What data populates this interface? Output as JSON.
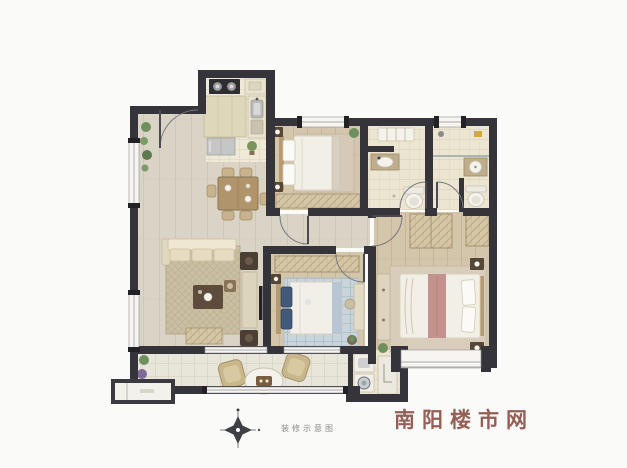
{
  "watermark": {
    "text": "南阳楼市网",
    "color": "#8a4f46"
  },
  "compass": {
    "icon": "compass-rose-icon",
    "caption": "装修示意图",
    "caption_color": "#8a8a8a"
  },
  "colors": {
    "wall": "#34343a",
    "bg": "#fafaf8",
    "floor-main": "#d9d4c5",
    "floor-wood": "#d3c6ab",
    "floor-tile": "#ebe5d2",
    "floor-balcony": "#e8e5da",
    "rug-living": "#cbbfa3",
    "rug-blue": "#c9d4db",
    "closet": "#d5c6a6",
    "bed-white": "#f2efe6",
    "wood": "#b0946c",
    "accent-pink": "#c4928c",
    "accent-navy": "#41597a",
    "plant": "#6f8f5f",
    "watermark": "#8a4f46",
    "caption": "#8a8a8a"
  }
}
